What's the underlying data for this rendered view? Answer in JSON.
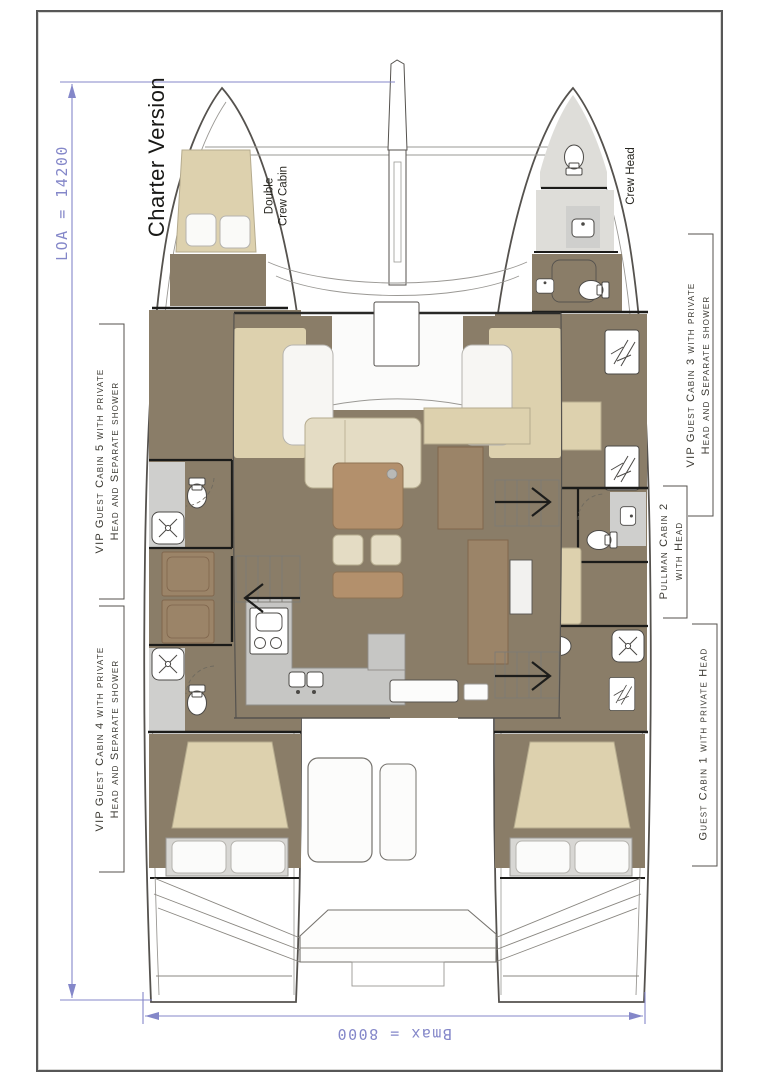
{
  "plan": {
    "version_label": "Charter Version",
    "dimensions": {
      "loa": "LOA = 14200",
      "bmax": "Bmax = 8000"
    },
    "bow_labels": {
      "double_crew_cabin": {
        "line1": "Double",
        "line2": "Crew Cabin"
      },
      "crew_head": "Crew Head"
    },
    "cabin_labels": [
      {
        "id": "vip-guest-cabin-5",
        "side": "port",
        "line1": "VIP Guest Cabin 5 with private",
        "line2": "Head and Separate shower"
      },
      {
        "id": "vip-guest-cabin-4",
        "side": "port",
        "line1": "VIP Guest Cabin 4 with private",
        "line2": "Head and Separate shower"
      },
      {
        "id": "vip-guest-cabin-3",
        "side": "starboard",
        "line1": "VIP Guest Cabin 3 with private",
        "line2": "Head and Separate shower"
      },
      {
        "id": "pullman-cabin-2",
        "side": "starboard",
        "line1": "Pullman Cabin 2",
        "line2": "with Head"
      },
      {
        "id": "guest-cabin-1",
        "side": "starboard",
        "line1": "Guest Cabin 1 with private Head",
        "line2": ""
      }
    ],
    "colors": {
      "dimension_line": "#8487c9",
      "cabin_floor": "#8a7d68",
      "bed_cushion": "#ddd1ae",
      "wood_furniture": "#b3906c",
      "counter_gray": "#c6c6c4",
      "label_text": "#3c3a33"
    },
    "icons": [
      "toilet-icon",
      "sink-icon",
      "shower-icon",
      "deck-hatch-icon",
      "companionway-arrow-icon",
      "dimension-arrow-icon"
    ]
  }
}
